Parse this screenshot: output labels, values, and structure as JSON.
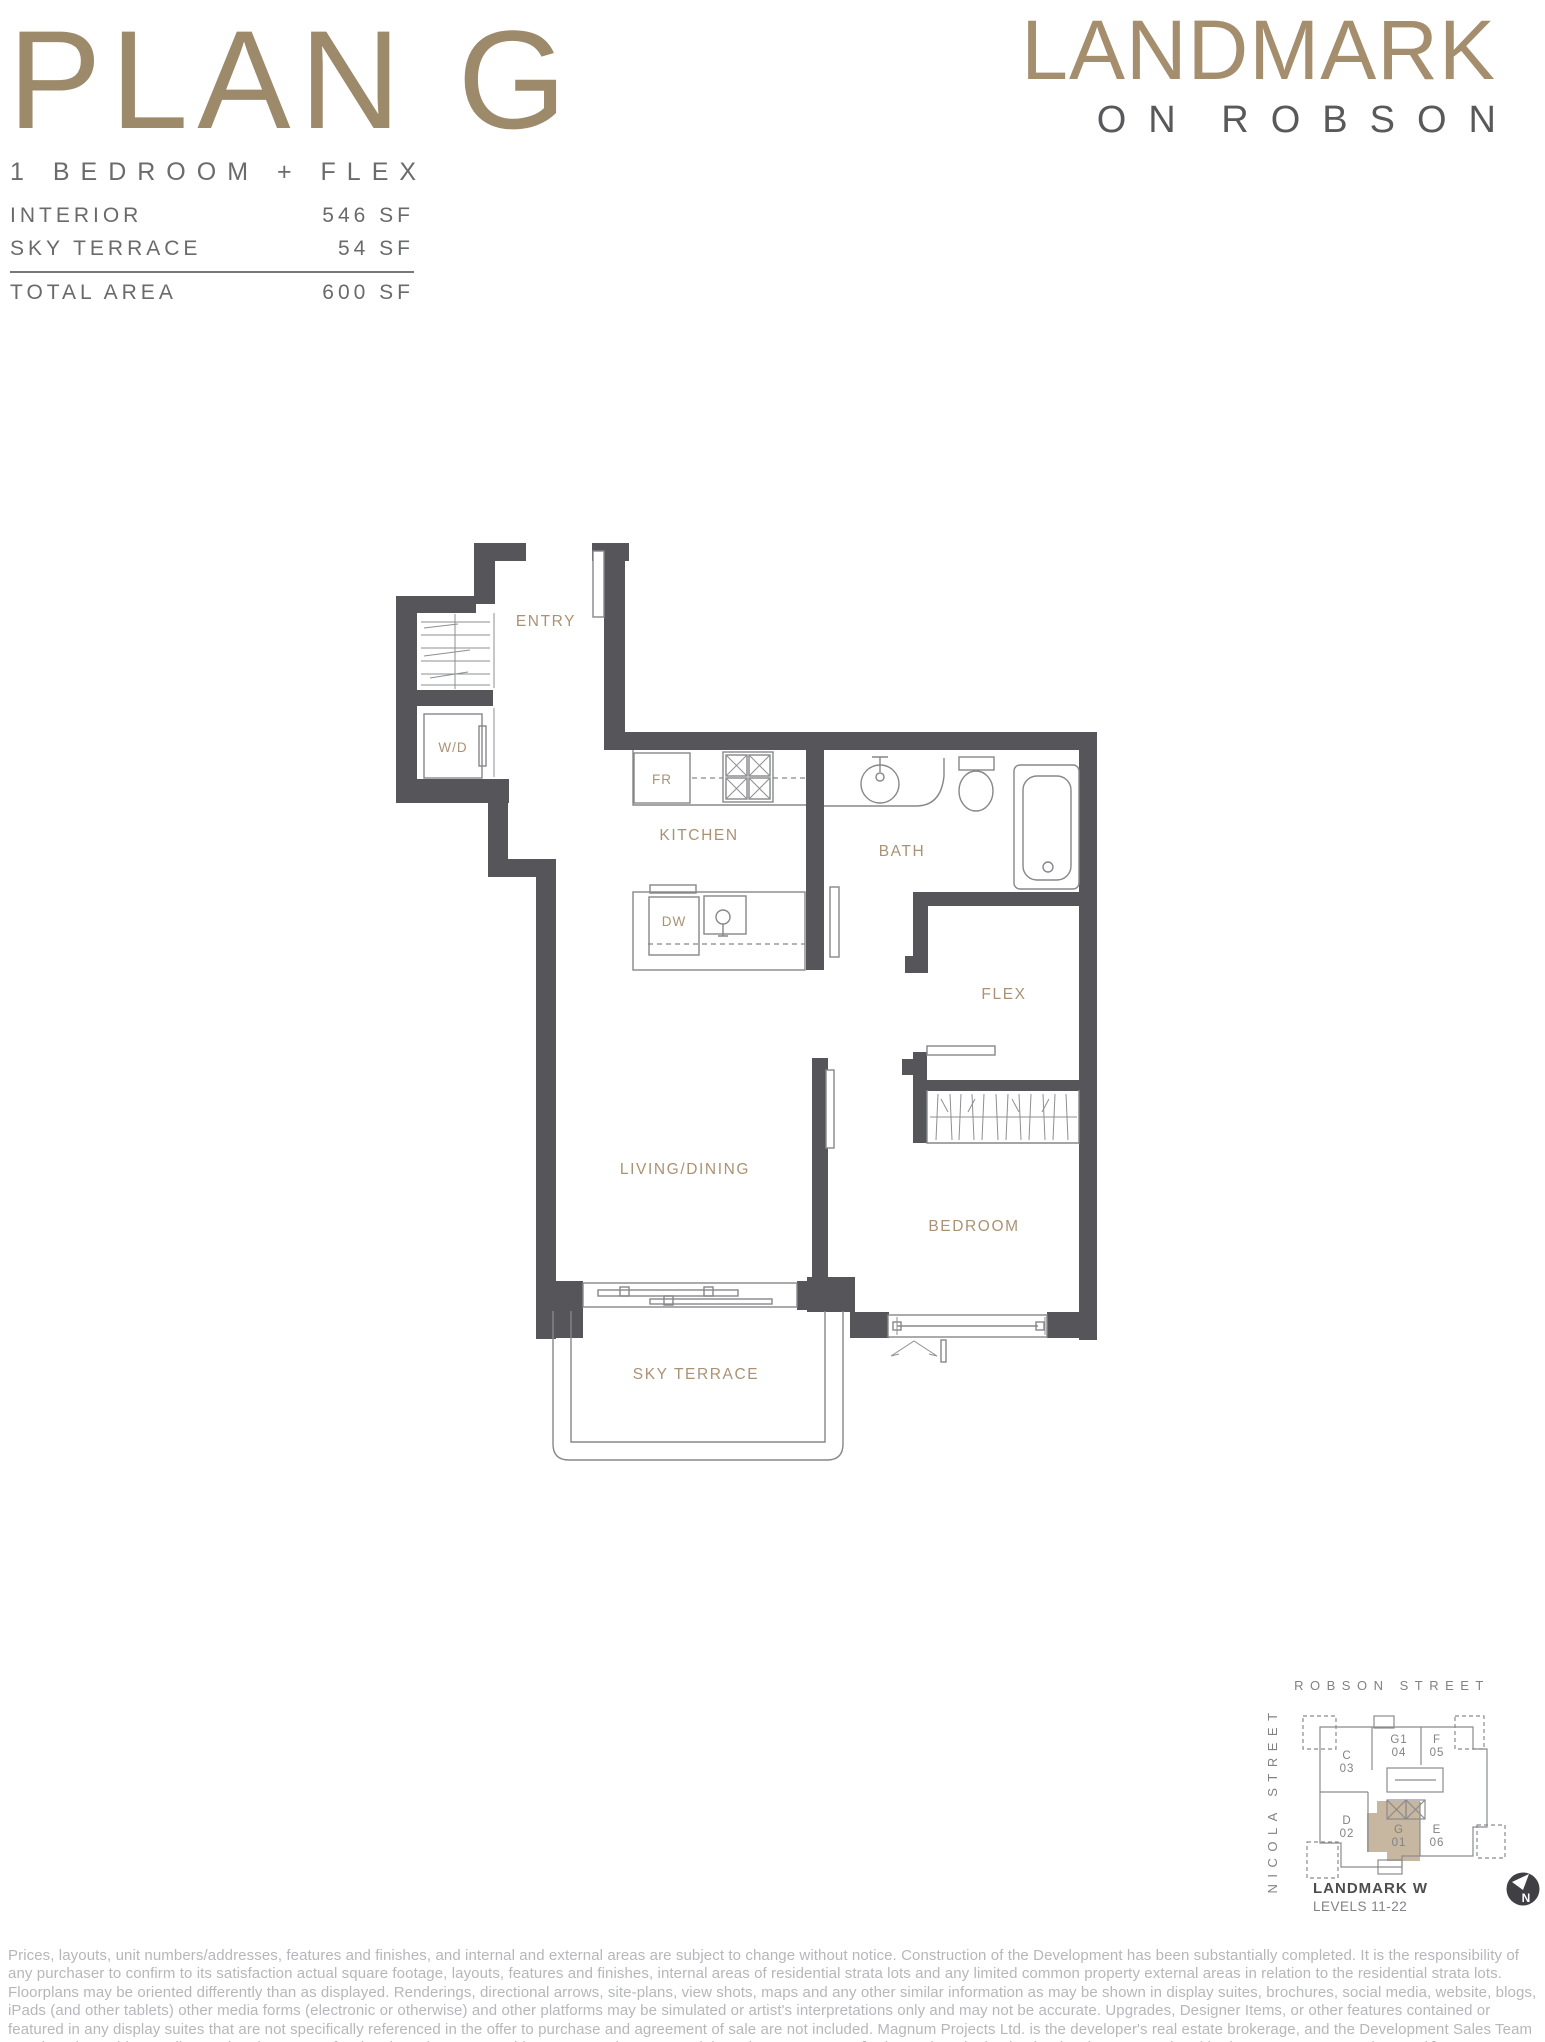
{
  "header": {
    "plan_name": "PLAN G",
    "plan_type": "1 BEDROOM + FLEX",
    "stats": [
      {
        "label": "INTERIOR",
        "value": "546 SF"
      },
      {
        "label": "SKY TERRACE",
        "value": "54 SF"
      },
      {
        "label": "TOTAL AREA",
        "value": "600 SF"
      }
    ]
  },
  "brand": {
    "name": "LANDMARK",
    "sub": "ON ROBSON"
  },
  "floorplan": {
    "rooms": {
      "entry": "ENTRY",
      "kitchen": "KITCHEN",
      "bath": "BATH",
      "flex": "FLEX",
      "living": "LIVING/DINING",
      "bedroom": "BEDROOM",
      "terrace": "SKY TERRACE"
    },
    "appliances": {
      "washer_dryer": "W/D",
      "fridge": "FR",
      "dishwasher": "DW"
    }
  },
  "keymap": {
    "street_top": "ROBSON STREET",
    "street_left": "NICOLA STREET",
    "units": [
      {
        "code": "C",
        "number": "03",
        "highlighted": false
      },
      {
        "code": "G1",
        "number": "04",
        "highlighted": false
      },
      {
        "code": "F",
        "number": "05",
        "highlighted": false
      },
      {
        "code": "D",
        "number": "02",
        "highlighted": false
      },
      {
        "code": "G",
        "number": "01",
        "highlighted": true
      },
      {
        "code": "E",
        "number": "06",
        "highlighted": false
      }
    ],
    "building": "LANDMARK W",
    "levels": "LEVELS 11-22",
    "compass": "N",
    "highlight_color": "#c7b7a1"
  },
  "colors": {
    "brand_gold": "#a58e6d",
    "title_gold": "#9d8a6b",
    "wall": "#56565a",
    "plan_line": "#85878a",
    "room_label": "#ab9274",
    "body_text": "#696a6c",
    "disclaimer_text": "#b6b7b9"
  },
  "disclaimer": "Prices, layouts, unit numbers/addresses, features and finishes, and internal and external areas are subject to change without notice. Construction of the Development has been substantially completed. It is the responsibility of any purchaser to confirm to its satisfaction actual square footage, layouts, features and finishes, internal areas of residential strata lots and any limited common property external areas in relation to the residential strata lots. Floorplans may be oriented differently than as displayed. Renderings, directional arrows, site-plans, view shots, maps and any other similar information as may be shown in display suites, brochures, social media, website, blogs, iPads (and other tablets) other media forms (electronic or otherwise) and other platforms may be simulated or artist's interpretations only and may not be accurate. Upgrades, Designer Items, or other features contained or featured in any display suites that are not specifically referenced in the offer to purchase and agreement of sale are not included. Magnum Projects Ltd. is the developer's real estate brokerage, and the Development Sales Team members it provides are licensed real estate professionals and cannot provide representation to potential purchasers, E.&O.E. [Sales and marketing by the developer's appointed brokerage, Magnum Projects Ltd.]"
}
